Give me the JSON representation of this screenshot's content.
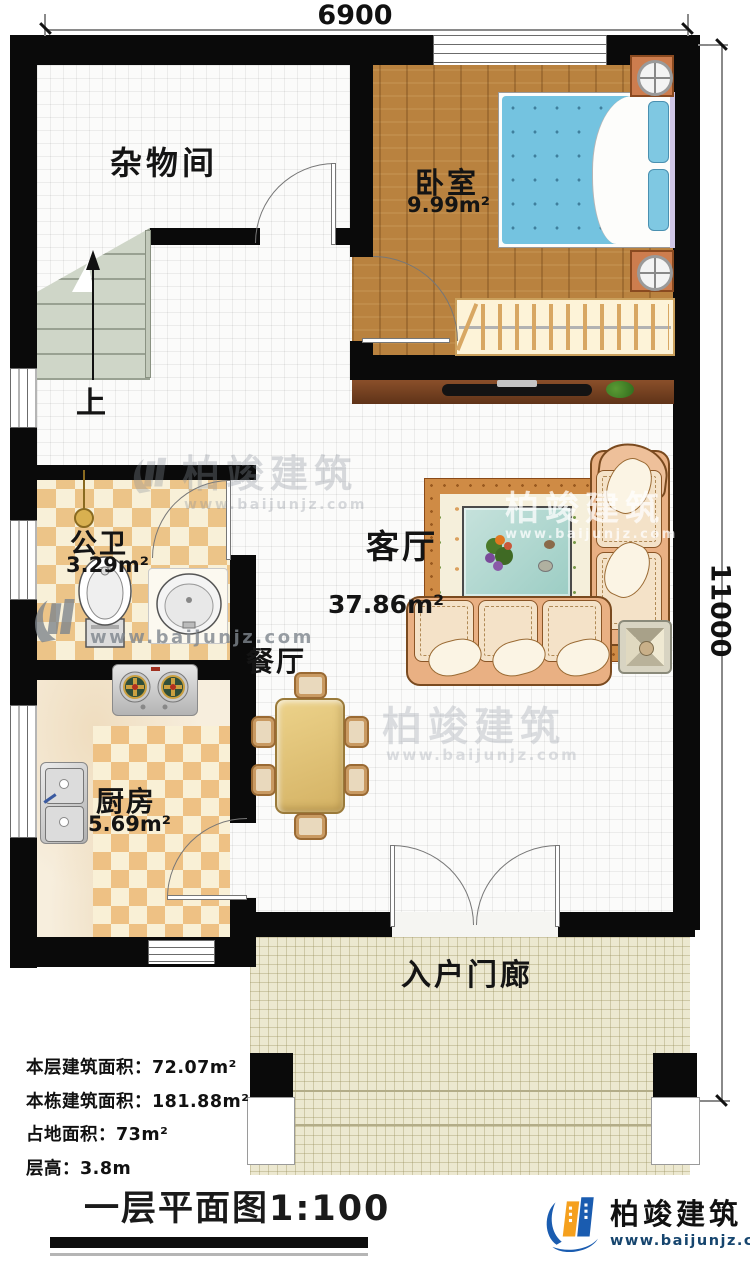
{
  "dimensions": {
    "top": "6900",
    "right": "11000"
  },
  "rooms": {
    "storage": {
      "label": "杂物间"
    },
    "bedroom": {
      "label": "卧室",
      "area": "9.99m²"
    },
    "living": {
      "label": "客厅",
      "area": "37.86m²"
    },
    "bathroom": {
      "label": "公卫",
      "area": "3.29m²"
    },
    "kitchen": {
      "label": "厨房",
      "area": "5.69m²"
    },
    "dining": {
      "label": "餐厅"
    },
    "porch": {
      "label": "入户门廊"
    }
  },
  "stairs": {
    "up": "上"
  },
  "stats": {
    "rows": [
      {
        "label": "本层建筑面积：",
        "value": "72.07m²"
      },
      {
        "label": "本栋建筑面积：",
        "value": "181.88m²"
      },
      {
        "label": "占地面积：",
        "value": "73m²"
      },
      {
        "label": "层高：",
        "value": "3.8m"
      }
    ]
  },
  "footer": {
    "title": "一层平面图1:100"
  },
  "brand": {
    "name": "柏竣建筑",
    "url": "www.baijunjz.com"
  },
  "watermark": {
    "name": "柏竣建筑",
    "url": "www.baijunjz.com"
  },
  "colors": {
    "wall": "#0a0a0a",
    "wood_floor": "#b9823f",
    "bed_blue": "#74c3e0",
    "checker_tan": "#ecc488",
    "copper": "#cd7d4e",
    "brand_blue": "#1a5cb0",
    "brand_orange": "#f5a01e",
    "porch_beige": "#ece8d0"
  }
}
